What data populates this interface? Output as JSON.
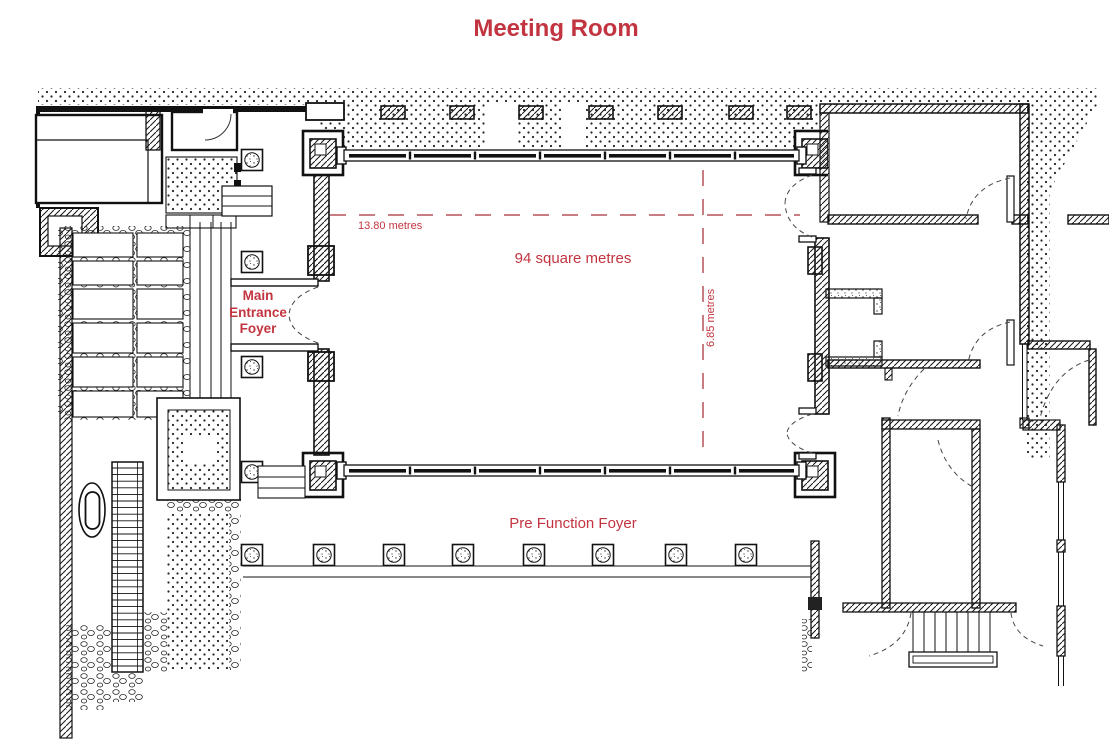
{
  "title": "Meeting Room",
  "labels": {
    "area": "94 square metres",
    "width_dim": "13.80 metres",
    "depth_dim": "6.85 metres",
    "entrance_lines": [
      "Main",
      "Entrance",
      "Foyer"
    ],
    "pre_function": "Pre Function Foyer"
  },
  "colors": {
    "annotation_red": "#c23540",
    "dash_red": "#b9505a",
    "drawing_black": "#141414",
    "background": "#ffffff"
  }
}
